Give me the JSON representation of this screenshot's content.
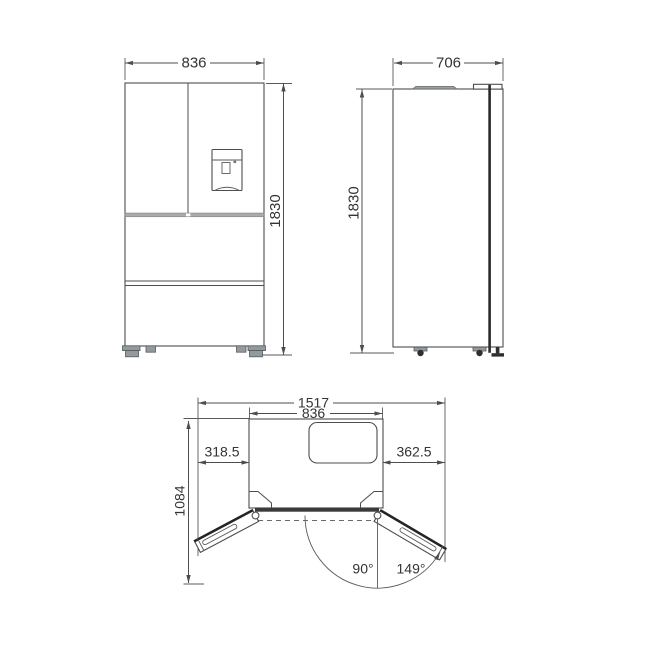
{
  "diagram": {
    "subject": "refrigerator-dimension-drawing",
    "views": {
      "front": {
        "width_label": "836",
        "height_label": "1830"
      },
      "side": {
        "depth_label": "706",
        "height_label": "1830"
      },
      "top_open": {
        "total_width_label": "1517",
        "body_width_label": "836",
        "left_clearance_label": "318.5",
        "right_clearance_label": "362.5",
        "open_depth_label": "1084",
        "door_angle_90_label": "90°",
        "door_angle_full_label": "149°"
      }
    },
    "colors": {
      "background": "#ffffff",
      "line": "#4d4d4d",
      "text": "#333333",
      "dark_edge": "#2f2f2f",
      "gray_fill": "#939a9e"
    }
  }
}
